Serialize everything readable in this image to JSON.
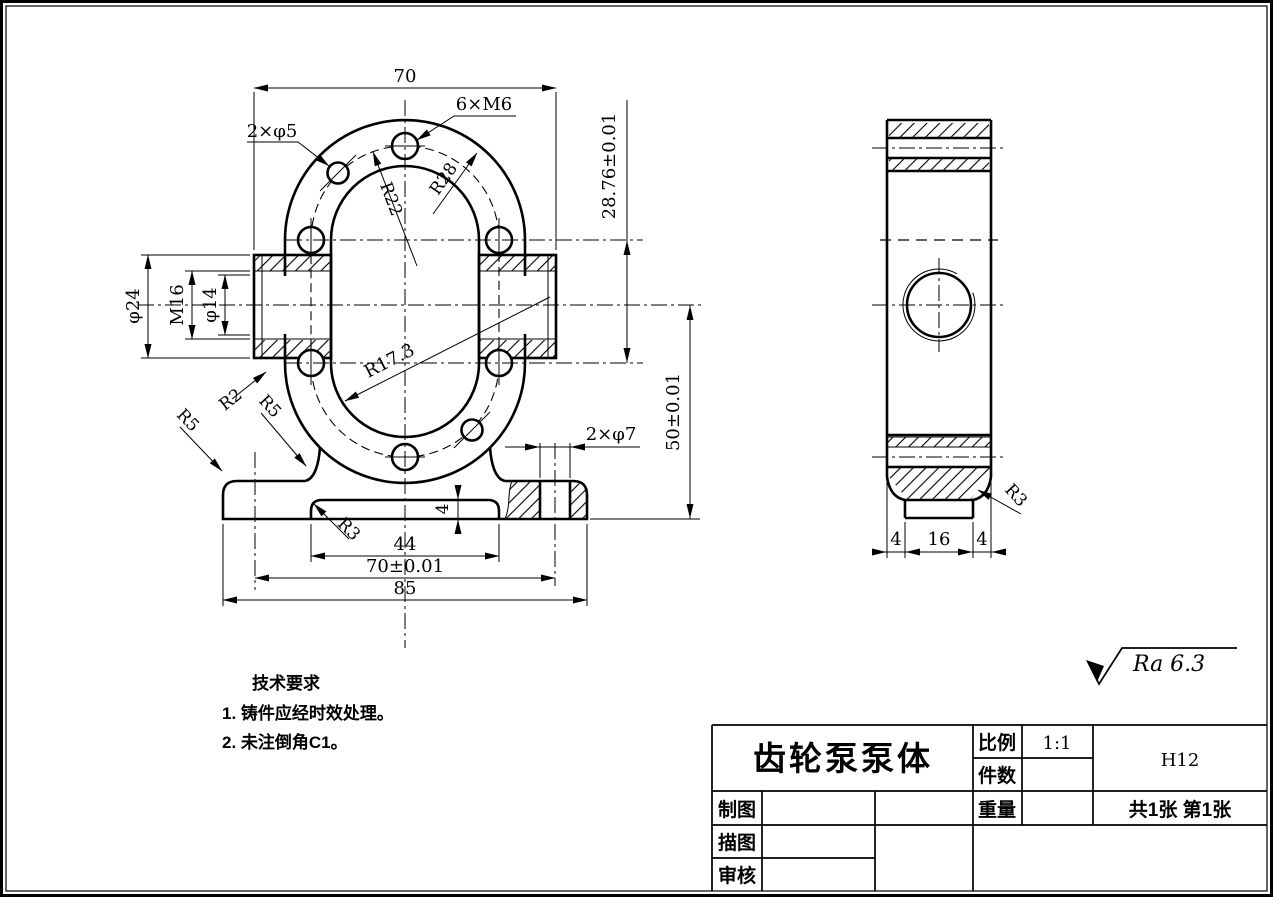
{
  "front": {
    "dim_width_top": "70",
    "label_dowel_holes": "2×φ5",
    "label_bolt_holes": "6×M6",
    "radius_bolt_circle": "R22",
    "radius_flange": "R28",
    "radius_cavity": "R17.3",
    "dim_center_distance": "28.76±0.01",
    "dim_center_to_base": "50±0.01",
    "dim_boss_od": "φ24",
    "dim_thread": "M16",
    "dim_bore": "φ14",
    "radius_r2": "R2",
    "radius_r5_corner": "R5",
    "radius_r5_fillet": "R5",
    "radius_r3_recess": "R3",
    "dim_recess_depth": "4",
    "label_base_holes": "2×φ7",
    "dim_recess_width": "44",
    "dim_hole_spacing": "70±0.01",
    "dim_base_width": "85"
  },
  "side": {
    "dim_left": "4",
    "dim_middle": "16",
    "dim_right": "4",
    "radius_r3": "R3"
  },
  "surface_finish": {
    "label": "Ra 6.3"
  },
  "technical_requirements": {
    "heading": "技术要求",
    "item_1": "1. 铸件应经时效处理。",
    "item_2": "2. 未注倒角C1。"
  },
  "title_block": {
    "part_name": "齿轮泵泵体",
    "scale_label": "比例",
    "scale_value": "1:1",
    "quantity_label": "件数",
    "quantity_value": "",
    "code": "H12",
    "weight_label": "重量",
    "weight_value": "",
    "sheet_info": "共1张 第1张",
    "drawn_by_label": "制图",
    "traced_by_label": "描图",
    "checked_by_label": "审核"
  }
}
